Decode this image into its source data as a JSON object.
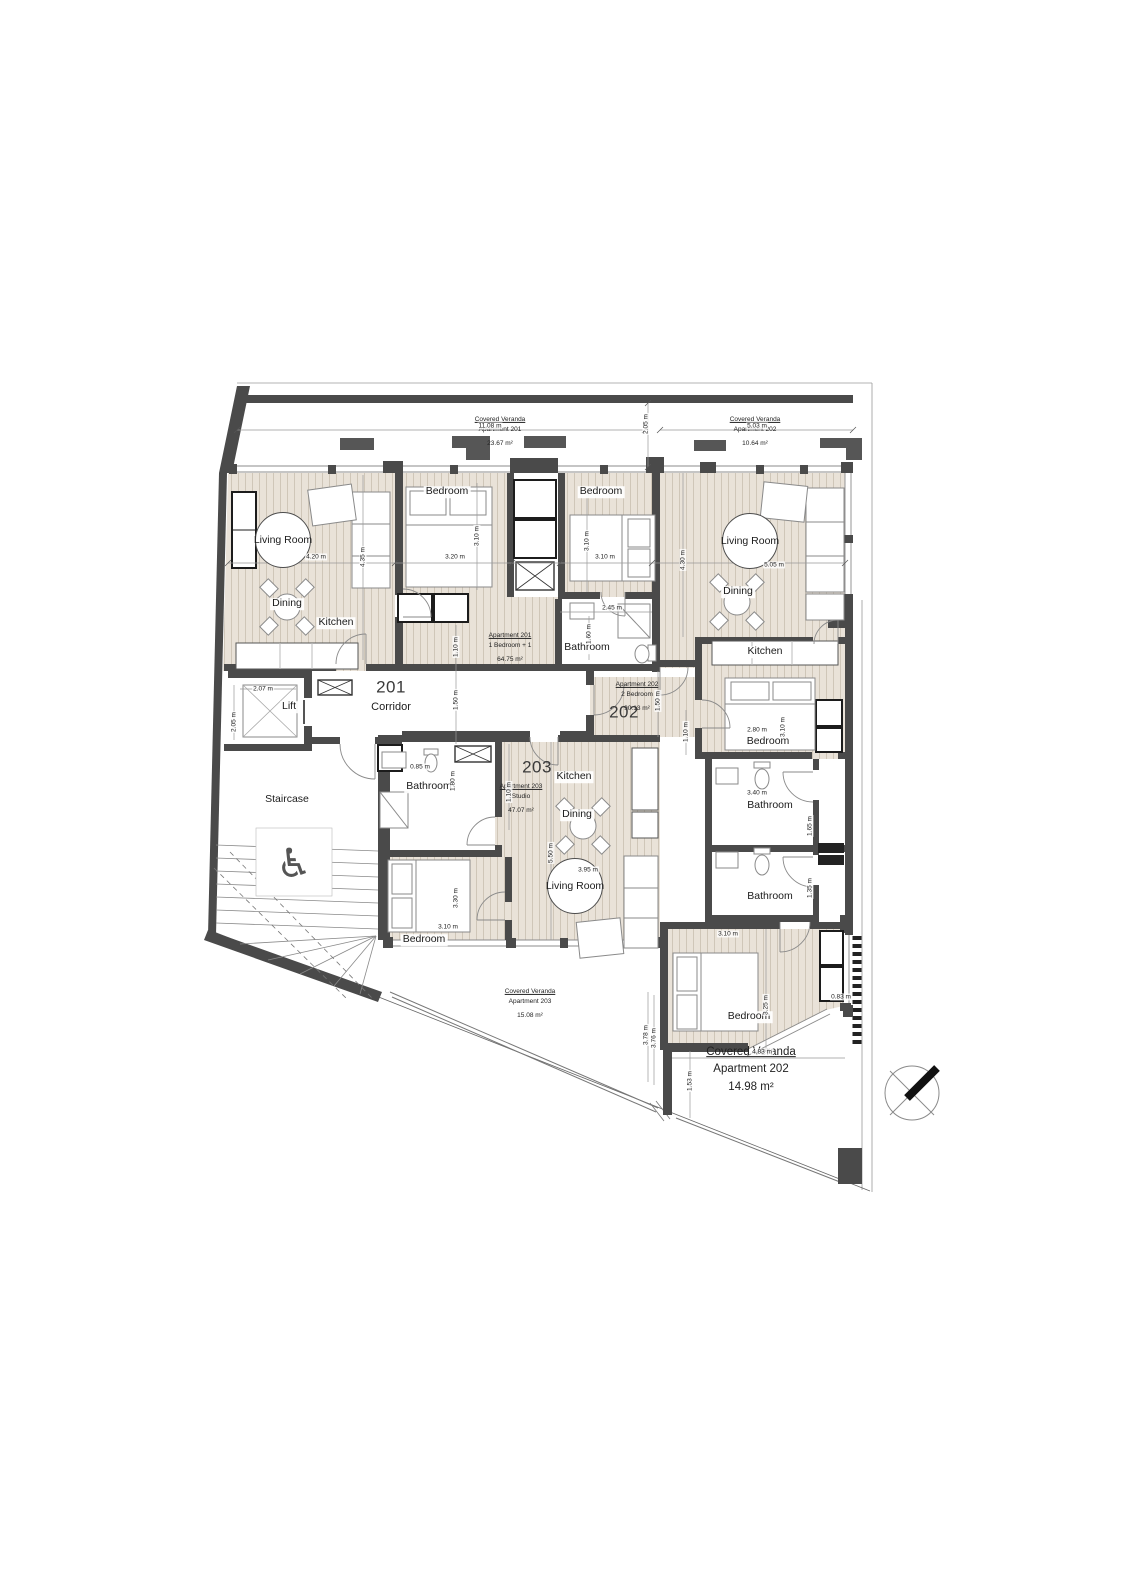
{
  "plan": {
    "numbers": {
      "a201": "201",
      "a202": "202",
      "a203": "203"
    },
    "rooms": {
      "living_room": "Living Room",
      "dining": "Dining",
      "kitchen": "Kitchen",
      "bedroom": "Bedroom",
      "bathroom": "Bathroom",
      "corridor": "Corridor",
      "lift": "Lift",
      "staircase": "Staircase"
    },
    "apartments": {
      "a201": {
        "title": "Apartment 201",
        "type": "1 Bedroom + 1",
        "area": "64.75 m²"
      },
      "a202": {
        "title": "Apartment 202",
        "type": "2 Bedroom",
        "area": "90.13 m²"
      },
      "a203": {
        "title": "Apartment 203",
        "type": "Studio",
        "area": "47.07 m²"
      }
    },
    "verandas": {
      "title": "Covered Veranda",
      "v201": {
        "apartment": "Apartment 201",
        "area": "23.67 m²"
      },
      "v202_top": {
        "apartment": "Apartment 202",
        "area": "10.64 m²"
      },
      "v203": {
        "apartment": "Apartment 203",
        "area": "15.08 m²"
      },
      "v202_bottom": {
        "apartment": "Apartment 202",
        "area": "14.98 m²"
      }
    },
    "dims": {
      "top_left": "11.08 m",
      "top_right": "5.03 m",
      "veranda_depth": "2.05 m",
      "lr201_w": "4.20 m",
      "lr201_h": "4.35 m",
      "br201a_w": "3.20 m",
      "br201a_h": "3.10 m",
      "br201b_w": "3.10 m",
      "br201b_h": "3.10 m",
      "bath201_w": "2.45 m",
      "bath201_h": "1.60 m",
      "hall201": "1.10 m",
      "corridor": "1.50 m",
      "hall202a": "1.50 m",
      "hall202b": "1.10 m",
      "hall203": "1.10 m",
      "lr202_w": "5.05 m",
      "lr202_h": "4.30 m",
      "br202a_w": "2.80 m",
      "br202a_h": "3.10 m",
      "bath202_w": "3.40 m",
      "bath202a_h": "1.65 m",
      "bath202b_h": "1.35 m",
      "br202c_w": "3.10 m",
      "br202c_h": "3.25 m",
      "br202c_off": "0.83 m",
      "ver202_w": "4.83 m",
      "ver202_h": "1.53 m",
      "ver203_d1": "3.78 m",
      "ver203_d2": "3.76 m",
      "st203_h": "5.50 m",
      "lr203_w": "3.95 m",
      "br203_h": "3.30 m",
      "br203_w": "3.10 m",
      "bath203_h": "1.80 m",
      "bath203_w": "0.85 m",
      "lift_w": "2.07 m",
      "lift_h": "2.05 m"
    }
  }
}
